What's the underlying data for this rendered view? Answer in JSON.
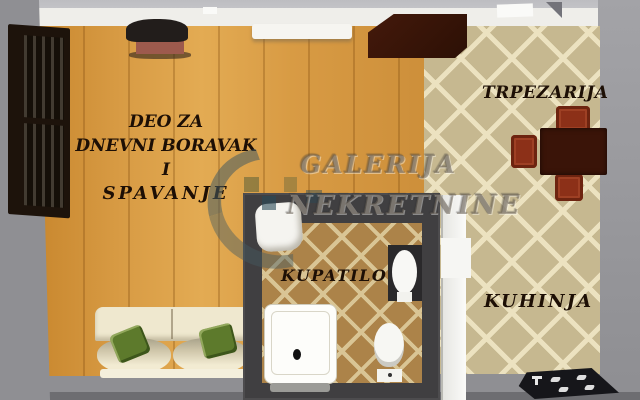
{
  "labels": {
    "living": {
      "lines": [
        "DEO ZA",
        "DNEVNI BORAVAK",
        "I",
        "SPAVANJE"
      ]
    },
    "dining": "TRPEZARIJA",
    "bathroom": "KUPATILO",
    "kitchen": "KUHINJA"
  },
  "watermark": {
    "line1": "GALERIJA",
    "line2": "NEKRETNINE"
  },
  "colors": {
    "wood_floor": "#d79a43",
    "tile_floor": "#c6b890",
    "tile_line": "#ece2c0",
    "bathroom_tile": "#ac8349",
    "bathroom_wall": "#403f41",
    "outer_wall": "#8f8f93",
    "label_text": "#1d0f05",
    "watermark_text": "#6e645a",
    "sofa_cream": "#efe8cf",
    "pillow_green": "#5d7a2c",
    "table_brown": "#3a1408",
    "chair_red": "#8c3018"
  }
}
